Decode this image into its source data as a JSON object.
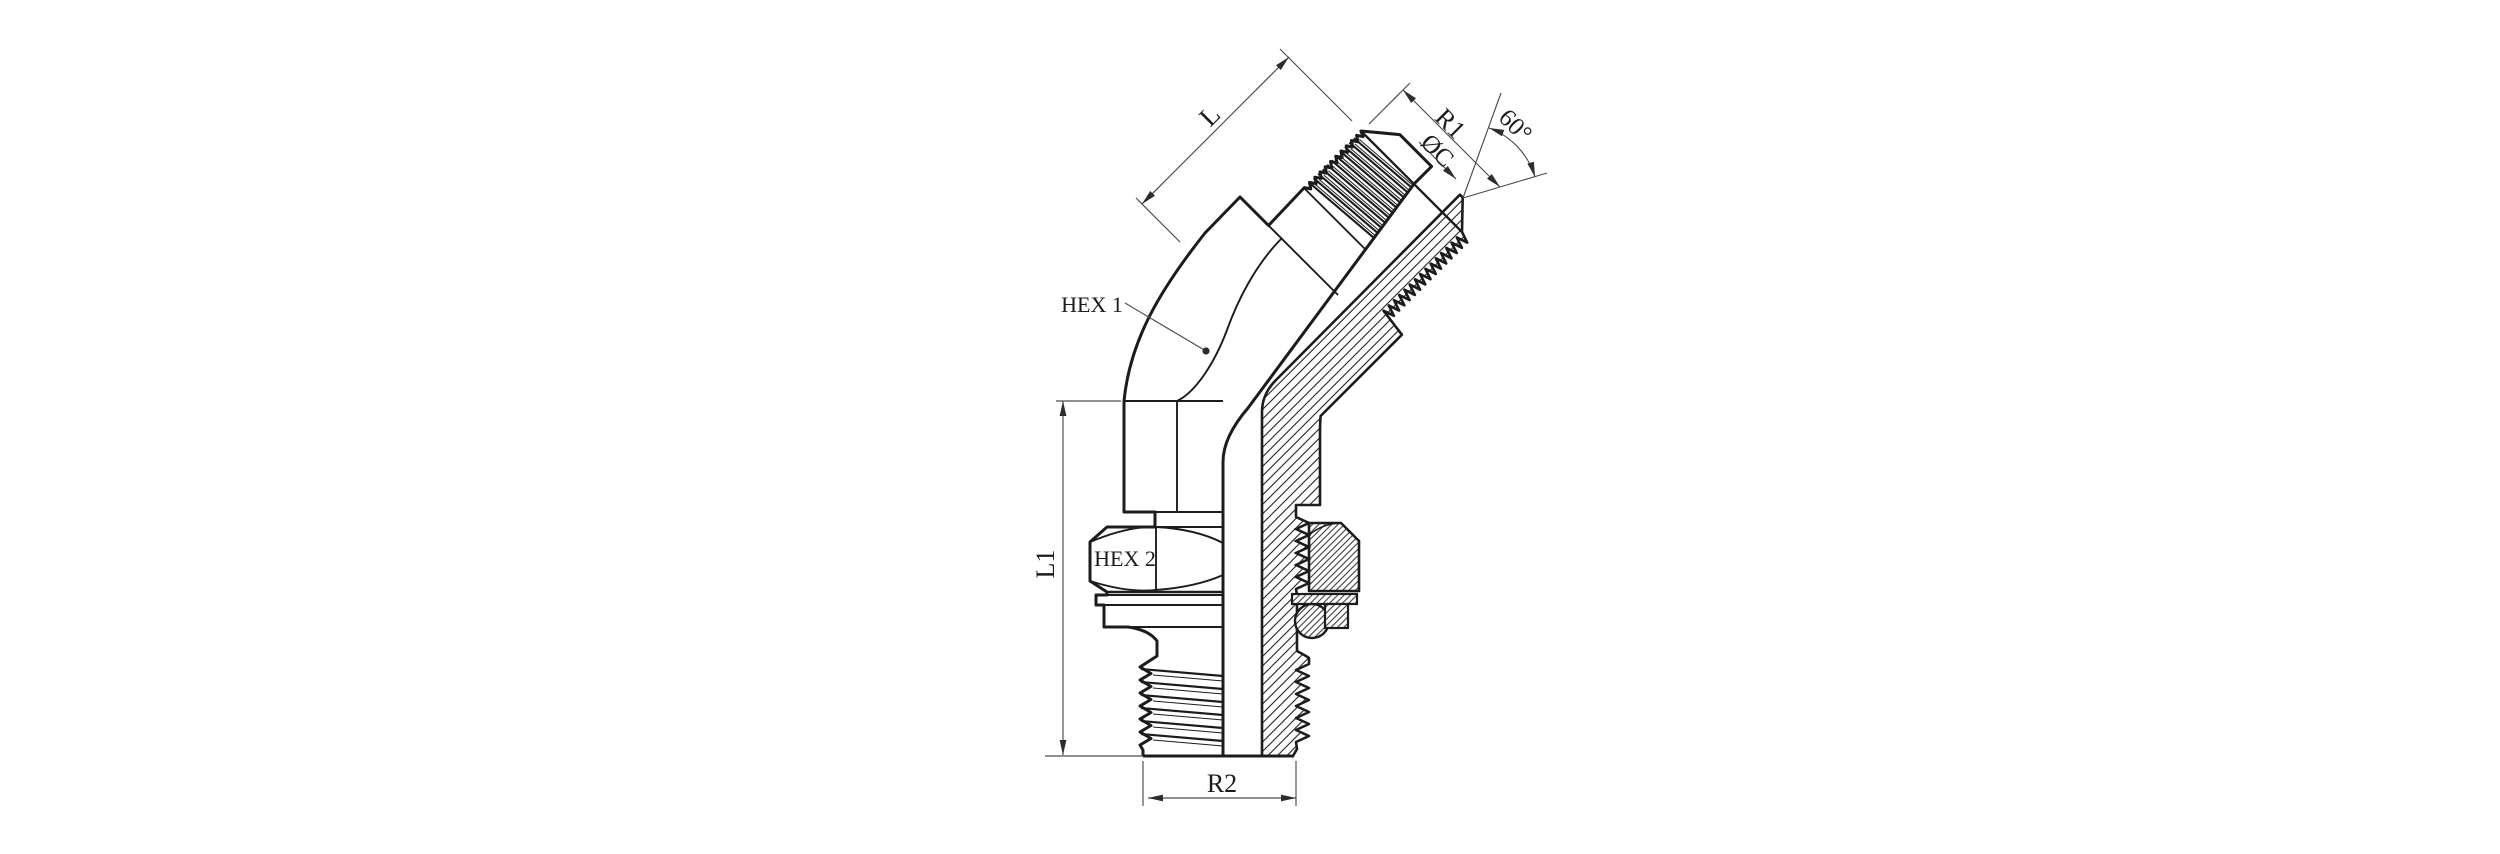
{
  "page": {
    "background": "#ffffff",
    "ink": "#1c1c1c",
    "dim_line_color": "#4d4d4d"
  },
  "drawing": {
    "kind": "technical-drawing",
    "view": "45-degree elbow adapter fitting, half-section",
    "callouts": [
      "HEX 1",
      "HEX 2"
    ],
    "dimensions": [
      "L",
      "R1",
      "ØC",
      "60°",
      "L1",
      "R2"
    ]
  },
  "labels": {
    "l": {
      "text": "L"
    },
    "r1": {
      "text": "R1"
    },
    "oc": {
      "text": "ØC"
    },
    "angle": {
      "text": "60°"
    },
    "hex1": {
      "text": "HEX 1"
    },
    "hex2": {
      "text": "HEX 2"
    },
    "l1": {
      "text": "L1"
    },
    "r2": {
      "text": "R2"
    }
  }
}
